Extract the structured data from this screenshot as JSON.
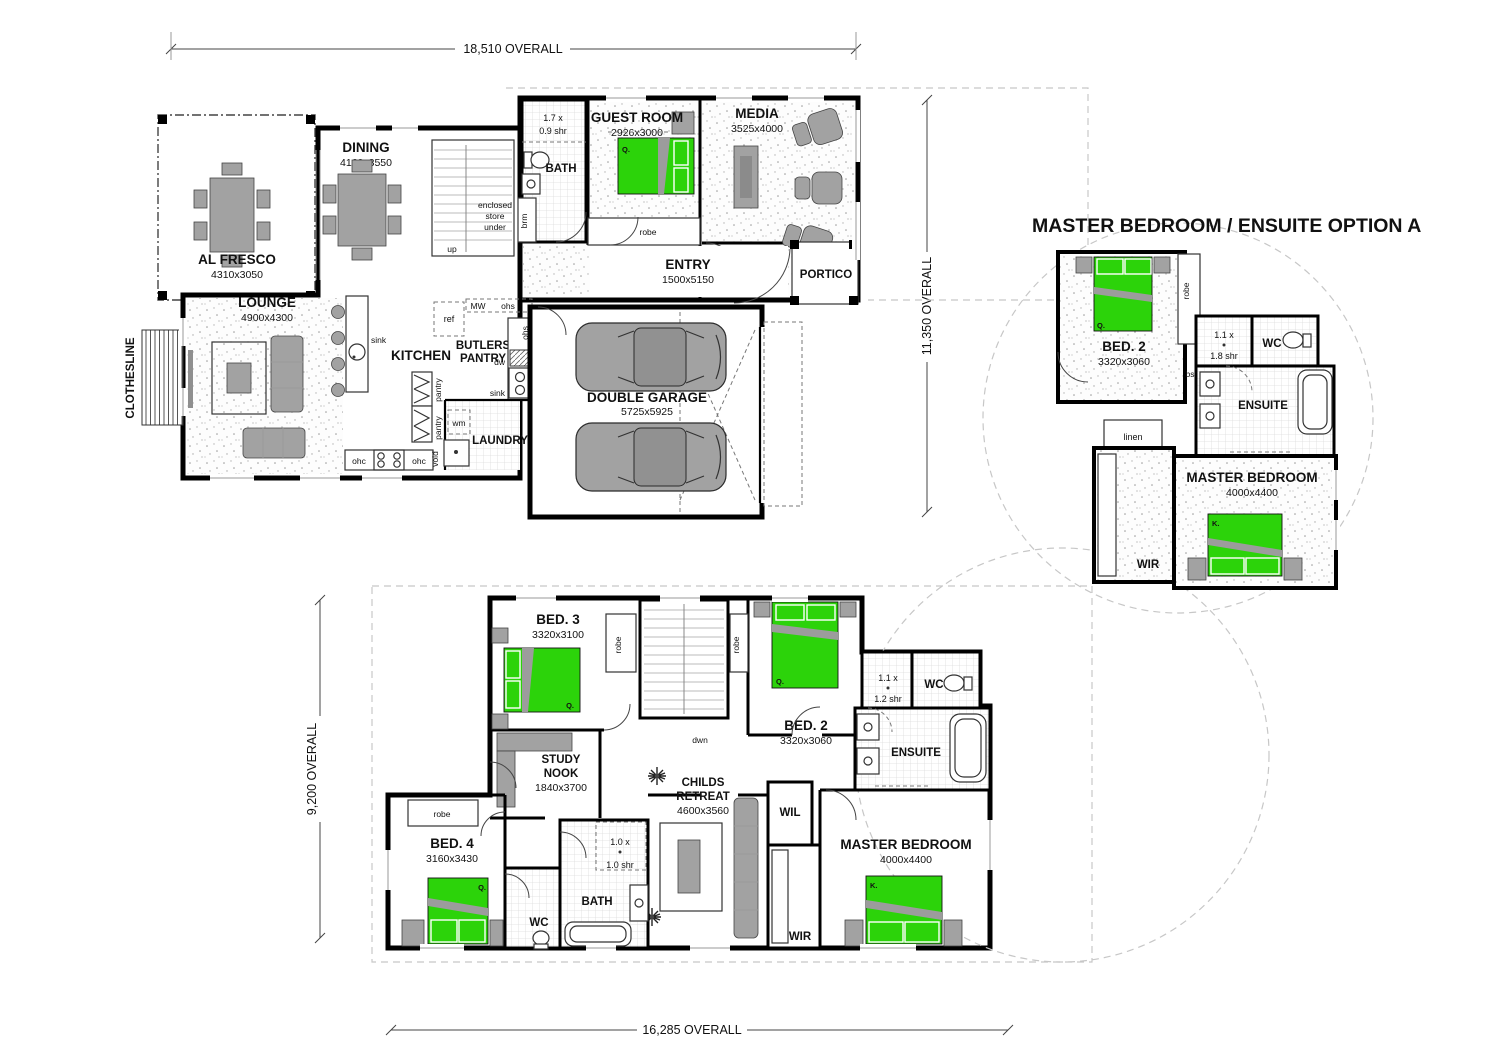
{
  "title": "MASTER BEDROOM / ENSUITE OPTION A",
  "dims": {
    "top": "18,510 OVERALL",
    "right": "11,350 OVERALL",
    "left": "9,200 OVERALL",
    "bottom": "16,285 OVERALL"
  },
  "tags": {
    "robe": "robe",
    "ohs": "ohs",
    "ohc": "ohc",
    "pantry": "pantry",
    "sink": "sink",
    "wm": "wm",
    "dw": "dw",
    "ref": "ref",
    "mw": "MW",
    "void": "void",
    "brm": "brm",
    "linen": "linen",
    "bs": "bs",
    "up": "up",
    "dwn": "dwn",
    "q": "Q.",
    "k": "K.",
    "wc": "WC",
    "wil": "WIL",
    "wir": "WIR"
  },
  "ground": {
    "al_fresco": {
      "name": "AL FRESCO",
      "size": "4310x3050"
    },
    "dining": {
      "name": "DINING",
      "size": "4160x3550"
    },
    "lounge": {
      "name": "LOUNGE",
      "size": "4900x4300"
    },
    "kitchen": {
      "name": "KITCHEN"
    },
    "butlers": {
      "l1": "BUTLERS",
      "l2": "PANTRY"
    },
    "laundry": {
      "name": "LAUNDRY"
    },
    "bath": {
      "name": "BATH"
    },
    "shower": {
      "l1": "1.7 x",
      "l2": "0.9 shr"
    },
    "guest": {
      "name": "GUEST ROOM",
      "size": "2926x3000"
    },
    "media": {
      "name": "MEDIA",
      "size": "3525x4000"
    },
    "entry": {
      "name": "ENTRY",
      "size": "1500x5150"
    },
    "portico": {
      "name": "PORTICO"
    },
    "garage": {
      "name": "DOUBLE GARAGE",
      "size": "5725x5925"
    },
    "clothesline": "CLOTHESLINE",
    "store": {
      "l1": "enclosed",
      "l2": "store",
      "l3": "under"
    }
  },
  "first": {
    "bed3": {
      "name": "BED. 3",
      "size": "3320x3100"
    },
    "bed2": {
      "name": "BED. 2",
      "size": "3320x3060"
    },
    "bed4": {
      "name": "BED. 4",
      "size": "3160x3430"
    },
    "study": {
      "l1": "STUDY",
      "l2": "NOOK",
      "size": "1840x3700"
    },
    "childs": {
      "l1": "CHILDS",
      "l2": "RETREAT",
      "size": "4600x3560"
    },
    "master": {
      "name": "MASTER BEDROOM",
      "size": "4000x4400"
    },
    "ensuite": "ENSUITE",
    "bath": "BATH",
    "shr_ens": {
      "l1": "1.1 x",
      "l2": "1.2 shr"
    },
    "shr_bath": {
      "l1": "1.0 x",
      "l2": "1.0 shr"
    }
  },
  "option": {
    "bed2": {
      "name": "BED. 2",
      "size": "3320x3060"
    },
    "master": {
      "name": "MASTER BEDROOM",
      "size": "4000x4400"
    },
    "ensuite": "ENSUITE",
    "shr": {
      "l1": "1.1 x",
      "l2": "1.8 shr"
    }
  },
  "colors": {
    "bed_green": "#2cd30a",
    "furniture_grey": "#a2a2a2",
    "wall": "#000000"
  }
}
